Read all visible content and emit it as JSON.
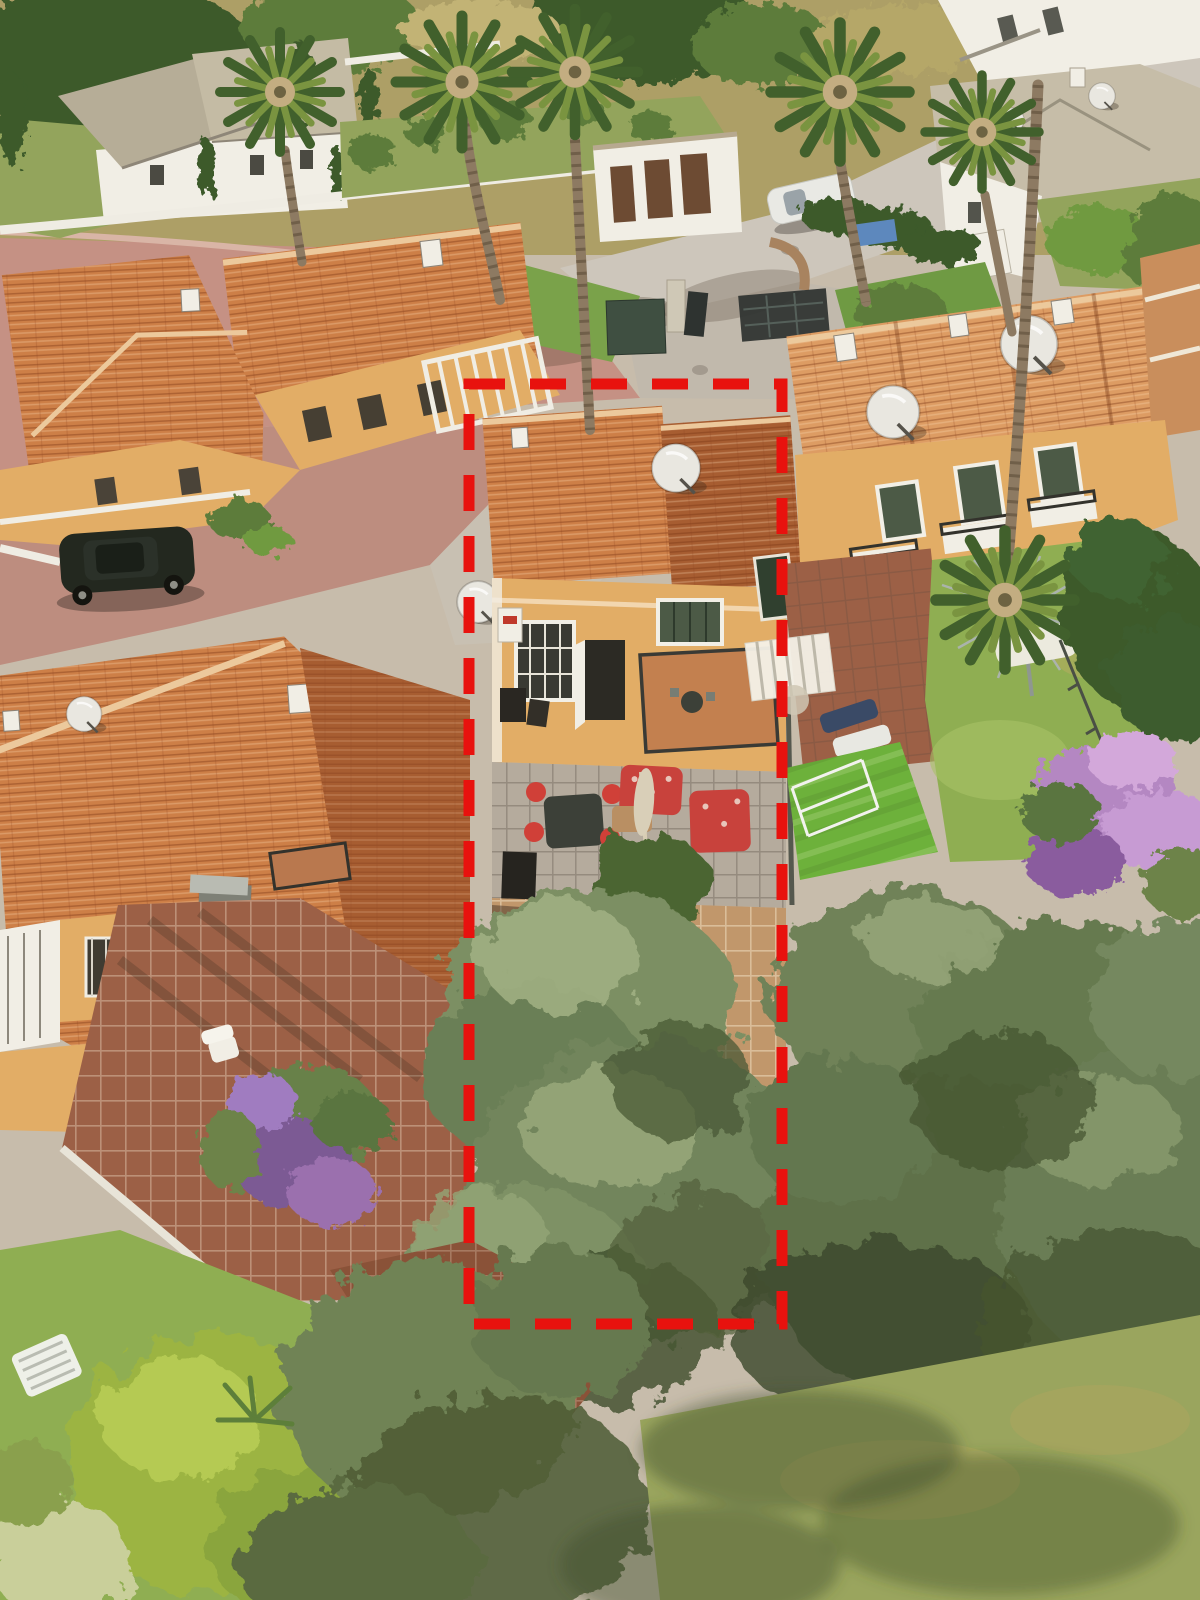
{
  "meta": {
    "type": "aerial-drone-photograph",
    "orientation": "portrait",
    "width_px": 1200,
    "height_px": 1600,
    "description": "Aerial view of a Mediterranean coastal urbanisation of yellow townhouses with terracotta roofs; a red dashed rectangle overlay marks the boundary of the advertised mid-terrace plot with its rear patio and large olive-tree garden."
  },
  "annotation": {
    "boundary": {
      "x": 469,
      "y": 384,
      "width": 313,
      "height": 940,
      "stroke_width": 11,
      "dash_pattern": "36 25",
      "color": "#e8120e",
      "meaning": "plot boundary of the advertised property"
    }
  },
  "palette": {
    "boundary_red": "#e8120e",
    "roof_terracotta": "#cd7f47",
    "roof_shaded": "#a75d31",
    "roof_light": "#dd9c63",
    "roof_ridge": "#ecc99c",
    "facade_yellow": "#e2ad66",
    "facade_shade": "#c08a4a",
    "trim_white": "#f1eee5",
    "street_pink": "#c59184",
    "street_gray": "#cdc6bb",
    "lawn_artificial": "#6db13b",
    "lawn_natural": "#8fae52",
    "lawn_villa": "#93a45c",
    "tree_dark": "#3c5a2c",
    "tree_mid": "#5d7c3b",
    "olive_light": "#9cab7f",
    "olive_mid": "#7c8f63",
    "olive_dark": "#46552f",
    "scrub_dry": "#ad9f66",
    "terrace_brown": "#9c6046",
    "courtyard_tan": "#c1976b",
    "flower_purple": "#9b6fae",
    "flower_pink": "#c79bd3",
    "palm_trunk": "#8d7a62",
    "palm_frond_dark": "#41602c",
    "palm_frond_light": "#7a9440",
    "dish_gray": "#e9e7e0",
    "car_dark": "#23281f",
    "car_white": "#e9e9e4"
  },
  "scene": {
    "setting": "Midday sun, strong shadows cast toward lower-left; pink paved lanes and grey asphalt street wind between terraced houses.",
    "overlay": "Red dashed rectangle property-boundary annotation",
    "subject_property": {
      "description": "Mid-terrace townhouse inside the dashed boundary",
      "features": [
        "terracotta tiled roof with white satellite dish",
        "rear first-floor balcony with round table and two chairs",
        "barred window and open rear door",
        "ground patio with dark dining table and red-cushioned chairs",
        "two red floral sofas and cream parasol",
        "tan tiled courtyard",
        "two large silver-green olive trees filling the rear garden"
      ]
    },
    "surroundings": {
      "top_left": "Detached white villa with grey hip roof, cypress trees and walled lawn garden",
      "top_center": "Row of tall fan palms along community street and white boundary wall",
      "top_right": "White houses with pale grey tile roofs and satellite dishes, garage block with brown doors, parked white car, dark community entrance gates, blue tarp",
      "left": "Yellow townhouses with terracotta roofs, black SUV parked on pink-paved lane, brown tiled rear terrace with white plastic chair, grey concrete chimney, purple flowering shrub",
      "right": "Adjoining townhouses with balconies and dishes, bright artificial-grass garden with loungers and white drying rack, natural lawn with rotary clothes line and white hammock, dark conifer, purple oleander bushes",
      "bottom": "Dense olive canopy, bright lime shrub, white slatted garden bench, pale mown grass with long tree shadows"
    },
    "vehicles": [
      {
        "name": "black-suv",
        "location": "left lane beside townhouse"
      },
      {
        "name": "white-car",
        "location": "upper street near garage block"
      }
    ],
    "objects": [
      "satellite-dishes on several roofs",
      "white pergola slats over neighbour patio",
      "rotary clothes line in right garden",
      "stepping stones near entrance lawn",
      "entrance gate pillar and dark mesh gates"
    ]
  }
}
